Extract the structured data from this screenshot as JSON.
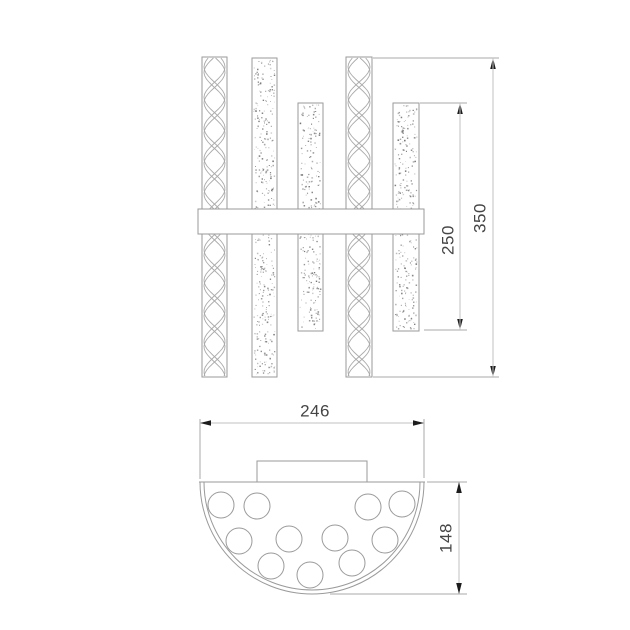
{
  "drawing": {
    "type": "technical-dimension-drawing",
    "views": [
      "front-view",
      "bottom-view"
    ]
  },
  "dims": {
    "total_height": {
      "label": "350"
    },
    "short_tube_height": {
      "label": "250"
    },
    "width": {
      "label": "246"
    },
    "depth": {
      "label": "148"
    }
  },
  "colors": {
    "background": "#ffffff",
    "outline": "#9a9a9a",
    "dim_line": "#c2c2c2",
    "ext_line": "#a8a8a8",
    "arrow": "#1c1c1c",
    "text": "#454545",
    "twist_line": "#ababab",
    "stipple_dot": "#6e6e6e"
  },
  "top_view": {
    "bars": [
      {
        "name": "tube-twist-1",
        "texture": "twist",
        "x": 202,
        "width": 25,
        "top": 57,
        "bottom": 377
      },
      {
        "name": "tube-stipple-1",
        "texture": "stipple",
        "x": 252,
        "width": 25,
        "top": 58,
        "bottom": 377
      },
      {
        "name": "tube-stipple-2",
        "texture": "stipple",
        "x": 298,
        "width": 25,
        "top": 103,
        "bottom": 331
      },
      {
        "name": "tube-twist-2",
        "texture": "twist",
        "x": 346,
        "width": 26,
        "top": 57,
        "bottom": 377
      },
      {
        "name": "tube-stipple-3",
        "texture": "stipple",
        "x": 393,
        "width": 26,
        "top": 103,
        "bottom": 331
      }
    ],
    "twist": {
      "period": 61,
      "edge_offset": 0.55
    },
    "mount_bar": {
      "x": 198,
      "y": 209,
      "width": 226,
      "height": 25
    }
  },
  "bottom_view": {
    "backplate": {
      "x": 257,
      "y": 461,
      "width": 110,
      "height": 21
    },
    "shade": {
      "cx": 312,
      "cy": 482,
      "r_outer": 112,
      "r_inner": 108
    },
    "holes": {
      "radius": 13,
      "centers": [
        [
          221,
          505
        ],
        [
          257,
          506
        ],
        [
          368,
          507
        ],
        [
          402,
          504
        ],
        [
          239,
          541
        ],
        [
          289,
          539
        ],
        [
          335,
          538
        ],
        [
          385,
          540
        ],
        [
          271,
          566
        ],
        [
          310,
          575
        ],
        [
          352,
          563
        ]
      ]
    }
  }
}
